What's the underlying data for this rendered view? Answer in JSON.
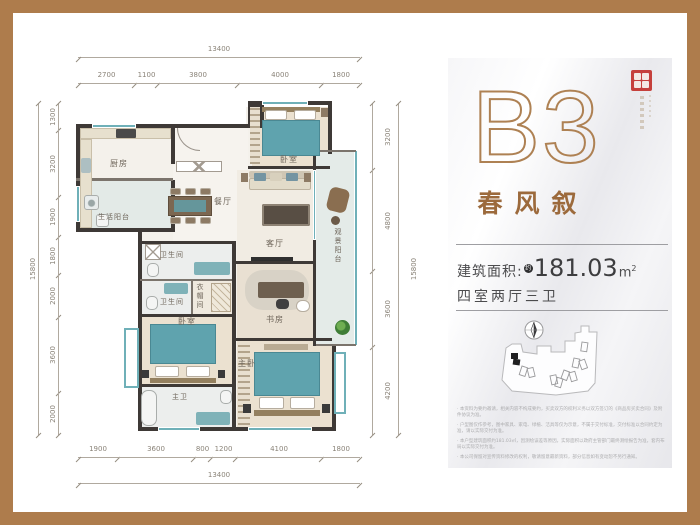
{
  "frame": {
    "border_color": "#ae7c4c"
  },
  "plan": {
    "rooms": {
      "kitchen": "厨房",
      "service_balcony": "生活阳台",
      "dining": "餐厅",
      "living": "客厅",
      "bedroom_top": "卧室",
      "view_balcony": "观景阳台",
      "bath_1": "卫生间",
      "bath_2": "卫生间",
      "cloakroom": "衣帽间",
      "bedroom_left": "卧室",
      "master_bath": "主卫",
      "master_bedroom": "主卧",
      "study": "书房"
    },
    "dimensions": {
      "top": {
        "total": "13400",
        "segments": [
          "2700",
          "1100",
          "3800",
          "4000",
          "1800"
        ]
      },
      "bottom": {
        "total": "13400",
        "segments": [
          "1900",
          "3600",
          "800",
          "1200",
          "4100",
          "1800"
        ]
      },
      "left": {
        "total": "15800",
        "segments": [
          "1300",
          "3200",
          "1900",
          "1800",
          "2000",
          "3600",
          "2000"
        ]
      },
      "right": {
        "total": "15800",
        "segments": [
          "3200",
          "4800",
          "3600",
          "4200"
        ]
      }
    }
  },
  "panel": {
    "unit_code": "B3",
    "unit_name": "春风叙",
    "area_label": "建筑面积:",
    "area_prefix": "约",
    "area_value": "181.03",
    "area_unit": "m",
    "area_unit_sup": "2",
    "layout_text": "四室两厅三卫",
    "accent_color": "#ae8153",
    "seal_color": "#c5403c",
    "disclaimers": [
      "· 本资料为要约邀请，相关内容不构成要约，买卖双方的权利义务以双方签订的《商品房买卖合同》及附件协议为准。",
      "· 户型图仅作参考，图中家具、家电、绿植、洁具等仅为示意，不属于交付标准，交付标准以合同约定为准，请以实际交付为准。",
      "· 本户型建筑面积约181.03㎡，因测绘误差等原因，实际面积以政府主管部门最终测绘报告为准，套内布局以实际交付为准。",
      "· 本公司保留对宣传资料修改的权利，敬请留意最新资料，部分信息如有变动恕不另行通知。"
    ]
  }
}
